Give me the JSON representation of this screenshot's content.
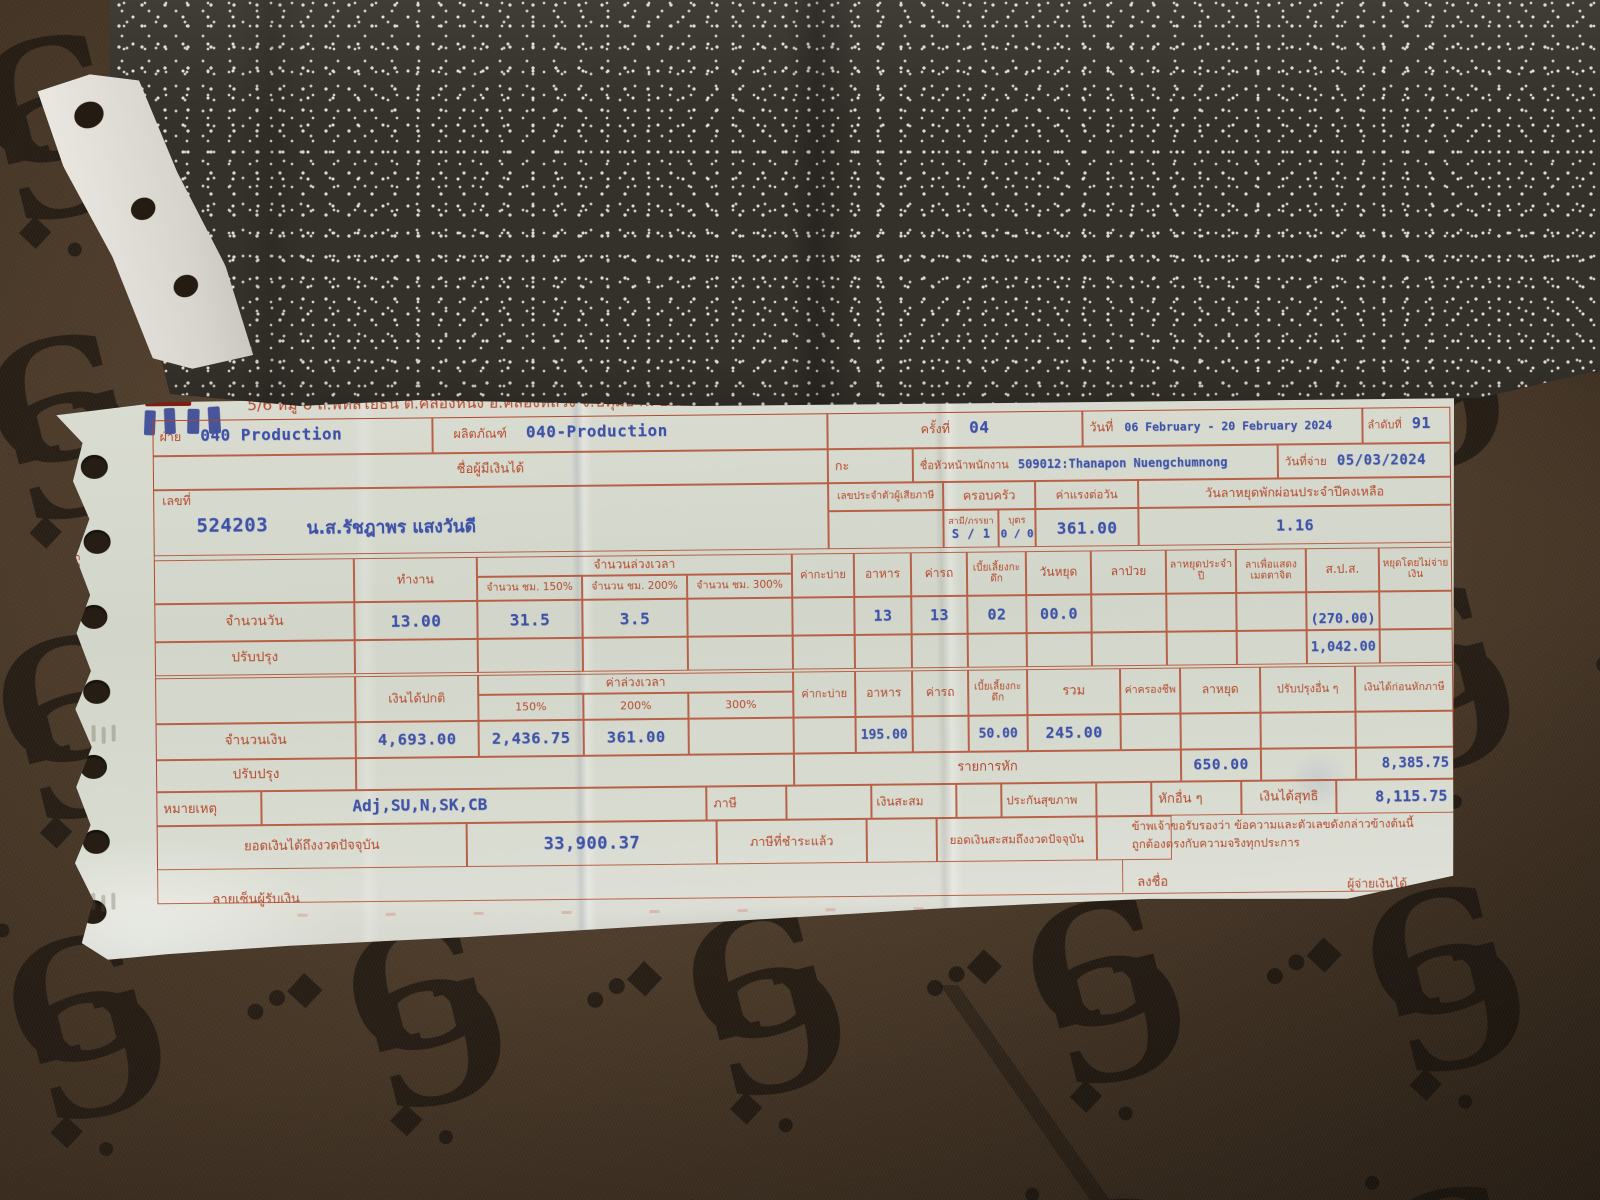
{
  "colors": {
    "form_red": "#b4492c",
    "print_blue": "#3e52a8",
    "paper": "#d7dacf",
    "fabric_brown": "#4c3b2a",
    "carbon_gray": "#34302a"
  },
  "header": {
    "address": "5/6 หมู่ 6 ถ.พหลโยธิน ต.คลองหนึ่ง อ.คลองหลวง จ.ปทุมธานี 12120",
    "doc_title": "ใบจ่ายเงินเดือน/โบนัส",
    "form_code": "ด0001-03-0260"
  },
  "info": {
    "dept": {
      "label": "ฝ่าย",
      "value": "040 Production"
    },
    "product": {
      "label": "ผลิตภัณฑ์",
      "value": "040-Production"
    },
    "period": {
      "label": "ครั้งที่",
      "value": "04"
    },
    "date_range": {
      "label": "วันที่",
      "value": "06 February - 20 February 2024"
    },
    "sequence": {
      "label": "ลำดับที่",
      "value": "91"
    },
    "payee_header": "ชื่อผู้มีเงินได้",
    "shift": {
      "label": "กะ",
      "value": ""
    },
    "supervisor": {
      "label": "ชื่อหัวหน้าพนักงาน",
      "value": "509012:Thanapon Nuengchumnong"
    },
    "pay_date": {
      "label": "วันที่จ่าย",
      "value": "05/03/2024"
    },
    "employee": {
      "label": "เลขที่",
      "number": "524203",
      "name": "น.ส.รัชฎาพร แสงวันดี"
    },
    "tax_id": {
      "label": "เลขประจำตัวผู้เสียภาษี",
      "value": ""
    },
    "family": {
      "label": "ครอบครัว",
      "spouse_label": "สามี/ภรรยา",
      "spouse_value": "S / 1",
      "children_label": "บุตร",
      "children_value": "0 / 0"
    },
    "daily_wage": {
      "label": "ค่าแรงต่อวัน",
      "value": "361.00"
    },
    "annual_leave_remaining": {
      "label": "วันลาหยุดพักผ่อนประจำปีคงเหลือ",
      "value": "1.16"
    }
  },
  "days_table": {
    "headers": {
      "work": "ทำงาน",
      "overtime_group": "จำนวนล่วงเวลา",
      "ot150": "จำนวน ชม. 150%",
      "ot200": "จำนวน ชม. 200%",
      "ot300": "จำนวน ชม. 300%",
      "evening_shift": "ค่ากะบ่าย",
      "meal": "อาหาร",
      "transport": "ค่ารถ",
      "night_allowance": "เบี้ยเลี้ยงกะดึก",
      "holiday": "วันหยุด",
      "sick_leave": "ลาป่วย",
      "annual_leave": "ลาหยุดประจำปี",
      "compassionate_leave": "ลาเพื่อแสดงเมตตาจิต",
      "sso": "ส.ป.ส.",
      "unpaid_leave": "หยุดโดยไม่จ่ายเงิน"
    },
    "row_days": {
      "label": "จำนวนวัน",
      "work": "13.00",
      "ot150": "31.5",
      "ot200": "3.5",
      "ot300": "",
      "evening_shift": "",
      "meal": "13",
      "transport": "13",
      "night_allowance": "02",
      "holiday": "00.0",
      "sick_leave": "",
      "annual_leave": "",
      "compassionate_leave": "",
      "sso": "(270.00)",
      "unpaid_leave": ""
    },
    "row_adjust": {
      "label": "ปรับปรุง",
      "sso": "1,042.00"
    }
  },
  "money_table": {
    "headers": {
      "base_pay": "เงินได้ปกติ",
      "overtime_group": "ค่าล่วงเวลา",
      "ot150": "150%",
      "ot200": "200%",
      "ot300": "300%",
      "evening_shift": "ค่ากะบ่าย",
      "meal": "อาหาร",
      "transport": "ค่ารถ",
      "night_allowance": "เบี้ยเลี้ยงกะดึก",
      "total": "รวม",
      "cost_of_living": "ค่าครองชีพ",
      "leave": "ลาหยุด",
      "other_adjustments": "ปรับปรุงอื่น ๆ",
      "pre_tax_income": "เงินได้ก่อนหักภาษี"
    },
    "row_amount": {
      "label": "จำนวนเงิน",
      "base_pay": "4,693.00",
      "ot150": "2,436.75",
      "ot200": "361.00",
      "meal": "195.00",
      "night_allowance": "50.00",
      "total": "245.00"
    },
    "row_adjust": {
      "label": "ปรับปรุง",
      "deductions_label": "รายการหัก",
      "deduction_value": "650.00",
      "pre_tax_income": "8,385.75"
    }
  },
  "summary": {
    "remark": {
      "label": "หมายเหตุ",
      "value": "Adj,SU,N,SK,CB"
    },
    "tax_label": "ภาษี",
    "savings_label": "เงินสะสม",
    "health_insurance_label": "ประกันสุขภาพ",
    "other_deductions_label": "หักอื่น ๆ",
    "net_income": {
      "label": "เงินได้สุทธิ",
      "value": "8,115.75"
    },
    "ytd_income": {
      "label": "ยอดเงินได้ถึงงวดปัจจุบัน",
      "value": "33,900.37"
    },
    "tax_paid_label": "ภาษีที่ชำระแล้ว",
    "ytd_savings_label": "ยอดเงินสะสมถึงงวดปัจจุบัน",
    "certification_line1": "ข้าพเจ้าขอรับรองว่า ข้อความและตัวเลขดังกล่าวข้างต้นนี้",
    "certification_line2": "ถูกต้องตรงกับความจริงทุกประการ"
  },
  "footer": {
    "recipient_signature_label": "ลายเซ็นผู้รับเงิน",
    "sign_label": "ลงชื่อ",
    "payer_label": "ผู้จ่ายเงินได้"
  }
}
